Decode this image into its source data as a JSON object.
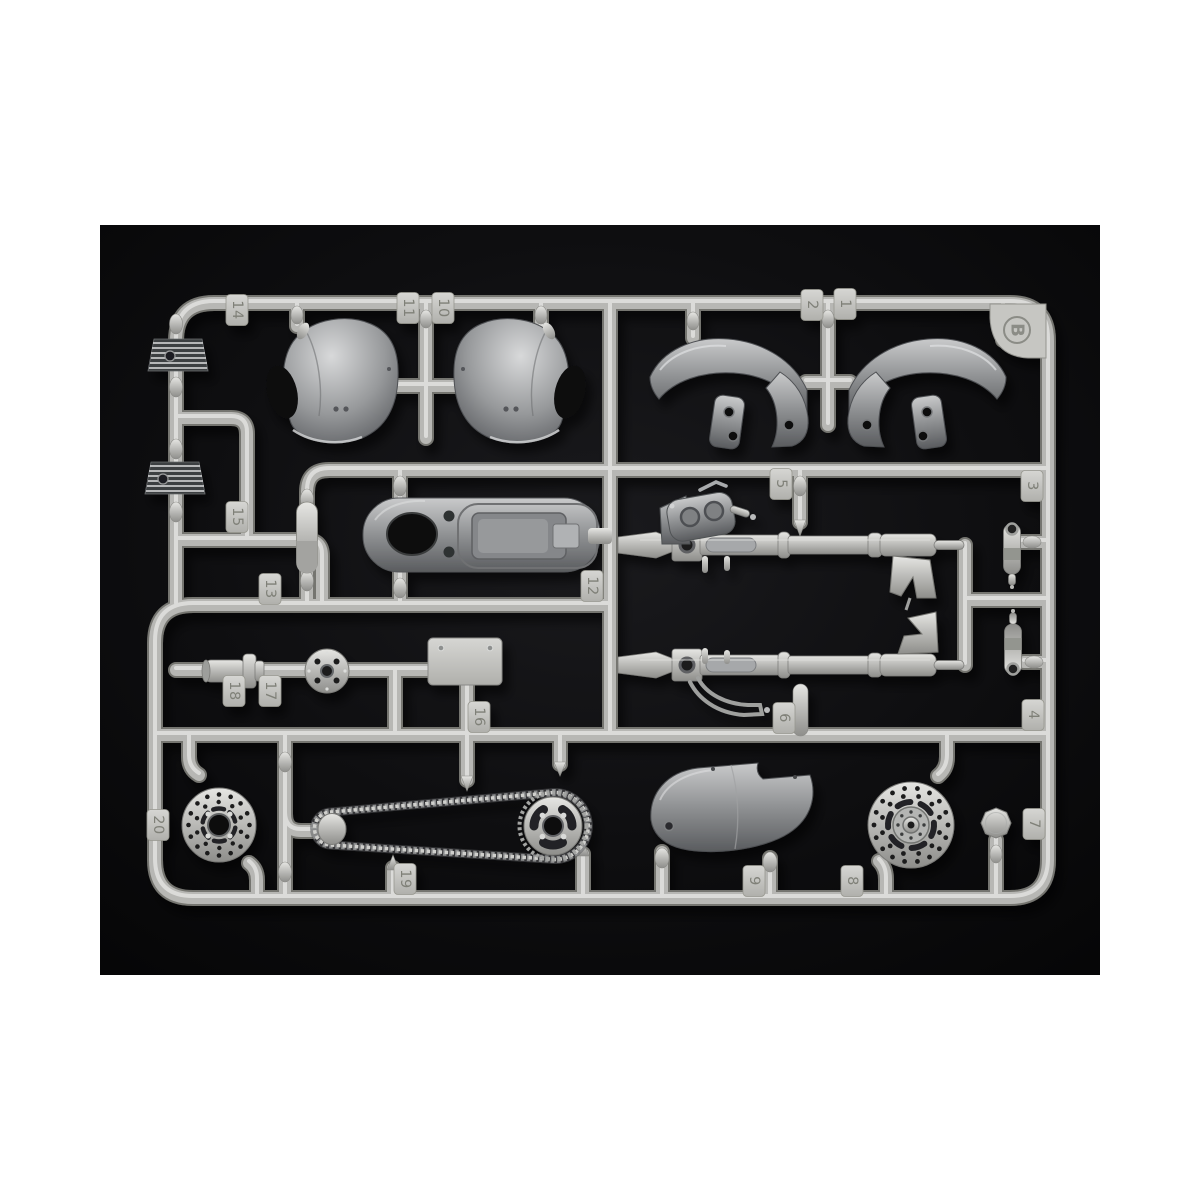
{
  "photo": {
    "description": "silver plastic model kit sprue with numbered motorcycle parts on black background",
    "margin_color": "#ffffff",
    "background_color": "#0c0c0e",
    "sprue_color": "#b7b7b4",
    "sprue_highlight_color": "#e2e2df",
    "sprue_shadow_color": "#74746f",
    "part_metal_color": "#8f9193",
    "tag_plate_color": "#c6c6c2",
    "tag_number_color": "#7f8078"
  },
  "sprue": {
    "letter": "B",
    "tags": [
      {
        "label": "1",
        "x": 845,
        "y": 304
      },
      {
        "label": "2",
        "x": 812,
        "y": 305
      },
      {
        "label": "3",
        "x": 1032,
        "y": 486
      },
      {
        "label": "4",
        "x": 1033,
        "y": 715
      },
      {
        "label": "5",
        "x": 781,
        "y": 484
      },
      {
        "label": "6",
        "x": 784,
        "y": 718
      },
      {
        "label": "7",
        "x": 1034,
        "y": 824
      },
      {
        "label": "8",
        "x": 852,
        "y": 881
      },
      {
        "label": "9",
        "x": 754,
        "y": 881
      },
      {
        "label": "10",
        "x": 443,
        "y": 308
      },
      {
        "label": "11",
        "x": 408,
        "y": 308
      },
      {
        "label": "12",
        "x": 592,
        "y": 586
      },
      {
        "label": "13",
        "x": 270,
        "y": 589
      },
      {
        "label": "14",
        "x": 237,
        "y": 310
      },
      {
        "label": "15",
        "x": 237,
        "y": 517
      },
      {
        "label": "16",
        "x": 479,
        "y": 717
      },
      {
        "label": "17",
        "x": 270,
        "y": 691
      },
      {
        "label": "18",
        "x": 234,
        "y": 691
      },
      {
        "label": "19",
        "x": 405,
        "y": 879
      },
      {
        "label": "20",
        "x": 158,
        "y": 825
      }
    ],
    "parts": [
      {
        "id": "1",
        "name": "front-fender-half-right"
      },
      {
        "id": "2",
        "name": "front-fender-half-left"
      },
      {
        "id": "3",
        "name": "shock-absorber-upper"
      },
      {
        "id": "4",
        "name": "shock-absorber-lower"
      },
      {
        "id": "5",
        "name": "front-fork-leg-with-brake-caliper"
      },
      {
        "id": "6",
        "name": "front-fork-leg"
      },
      {
        "id": "7",
        "name": "filler-cap-disc"
      },
      {
        "id": "8",
        "name": "front-brake-disc-with-hub"
      },
      {
        "id": "9",
        "name": "exhaust-heat-shield"
      },
      {
        "id": "10",
        "name": "helmet-half-right"
      },
      {
        "id": "11",
        "name": "helmet-half-left"
      },
      {
        "id": "12",
        "name": "fuel-tank-and-seat-base"
      },
      {
        "id": "13",
        "name": "silencer-capsule"
      },
      {
        "id": "14",
        "name": "cylinder-fin-block-upper"
      },
      {
        "id": "15",
        "name": "cylinder-fin-block-lower"
      },
      {
        "id": "16",
        "name": "number-plate"
      },
      {
        "id": "17",
        "name": "hub-plate-disc"
      },
      {
        "id": "18",
        "name": "rear-axle-hub"
      },
      {
        "id": "19",
        "name": "drive-chain-with-sprockets"
      },
      {
        "id": "20",
        "name": "rear-brake-disc"
      }
    ]
  }
}
